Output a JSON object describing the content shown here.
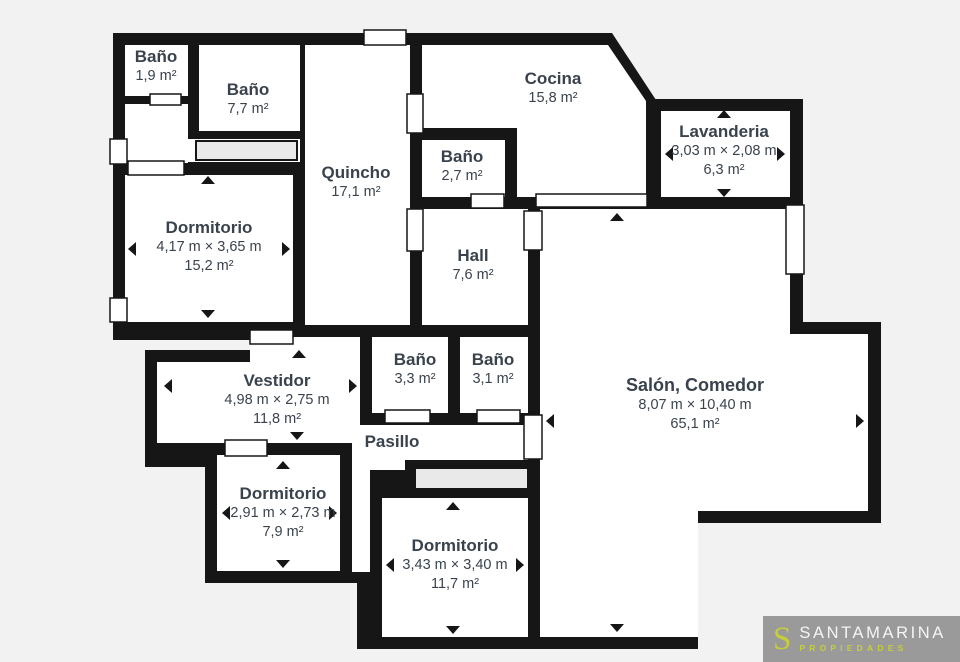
{
  "plan": {
    "rooms": [
      {
        "title": "Baño",
        "area": "1,9 m²"
      },
      {
        "title": "Baño",
        "area": "7,7 m²"
      },
      {
        "title": "Quincho",
        "area": "17,1 m²"
      },
      {
        "title": "Cocina",
        "area": "15,8 m²"
      },
      {
        "title": "Baño",
        "area": "2,7 m²"
      },
      {
        "title": "Lavanderia",
        "dimensions": "3,03 m × 2,08 m",
        "area": "6,3 m²"
      },
      {
        "title": "Dormitorio",
        "dimensions": "4,17 m × 3,65 m",
        "area": "15,2 m²"
      },
      {
        "title": "Hall",
        "area": "7,6 m²"
      },
      {
        "title": "Vestidor",
        "dimensions": "4,98 m × 2,75 m",
        "area": "11,8 m²"
      },
      {
        "title": "Baño",
        "area": "3,3 m²"
      },
      {
        "title": "Baño",
        "area": "3,1 m²"
      },
      {
        "title": "Salón, Comedor",
        "dimensions": "8,07 m × 10,40 m",
        "area": "65,1 m²"
      },
      {
        "title": "Pasillo"
      },
      {
        "title": "Dormitorio",
        "dimensions": "2,91 m × 2,73 m",
        "area": "7,9 m²"
      },
      {
        "title": "Dormitorio",
        "dimensions": "3,43 m × 3,40 m",
        "area": "11,7 m²"
      }
    ]
  },
  "logo": {
    "monogram": "S",
    "name": "SANTAMARINA",
    "tagline": "PROPIEDADES"
  },
  "colors": {
    "background": "#f2f2f2",
    "wall": "#161616",
    "room_fill": "#ffffff",
    "closet_fill": "#e9e9e9",
    "label_text": "#3a434d",
    "logo_background": "#9a9a9a",
    "logo_accent": "#c6ce3a",
    "logo_text": "#f5f5f5"
  }
}
